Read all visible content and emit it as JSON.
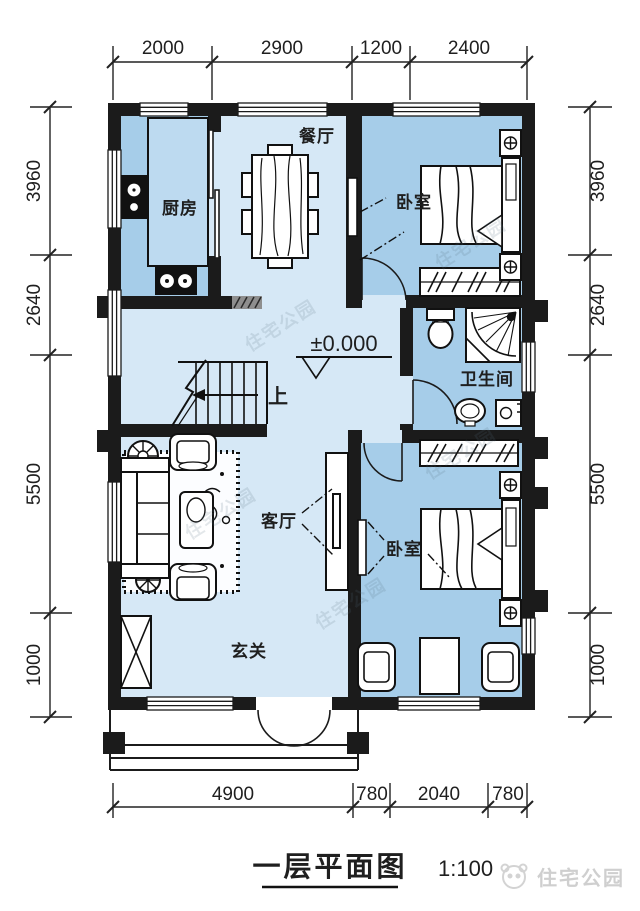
{
  "title": {
    "text": "一层平面图",
    "scale": "1:100"
  },
  "annotations": {
    "elevation": "±0.000",
    "stairs_up": "上"
  },
  "rooms": {
    "dining": "餐厅",
    "kitchen": "厨房",
    "bedroom_top": "卧室",
    "bathroom": "卫生间",
    "living": "客厅",
    "foyer": "玄关",
    "bedroom_bottom": "卧室"
  },
  "dimensions": {
    "top": [
      "2000",
      "2900",
      "1200",
      "2400"
    ],
    "bottom": [
      "4900",
      "780",
      "2040",
      "780"
    ],
    "left": [
      "3960",
      "2640",
      "5500",
      "1000"
    ],
    "right": [
      "3960",
      "2640",
      "5500",
      "1000"
    ]
  },
  "watermark": {
    "brand": "住宅公园"
  },
  "colors": {
    "wall": "#1b1b1b",
    "room_dark": "#a6cde9",
    "room_light": "#d6e8f6",
    "counter": "#bddaf0",
    "paper": "#ffffff"
  }
}
